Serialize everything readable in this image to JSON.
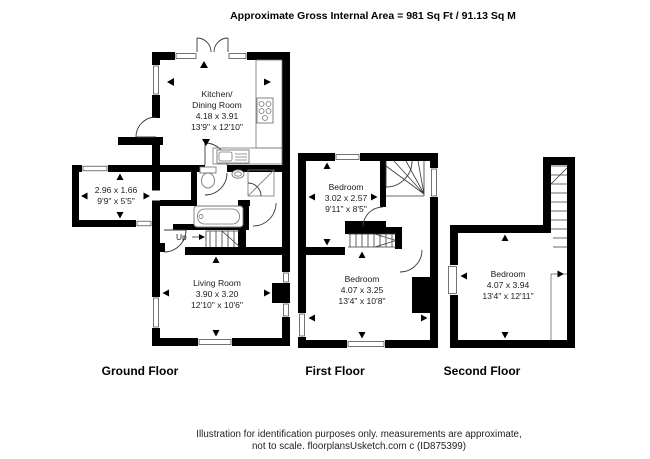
{
  "header": {
    "title": "Approximate Gross Internal Area = 981 Sq Ft / 91.13 Sq M"
  },
  "floors": {
    "ground": {
      "label": "Ground Floor",
      "kitchen": {
        "name1": "Kitchen/",
        "name2": "Dining Room",
        "metric": "4.18 x 3.91",
        "imperial": "13'9\" x 12'10\""
      },
      "annex": {
        "metric": "2.96 x 1.66",
        "imperial": "9'9\" x 5'5\""
      },
      "living": {
        "name": "Living Room",
        "metric": "3.90 x 3.20",
        "imperial": "12'10\" x 10'6\""
      },
      "stairs_label": "Up"
    },
    "first": {
      "label": "First Floor",
      "bedroom_small": {
        "name": "Bedroom",
        "metric": "3.02 x 2.57",
        "imperial": "9'11\" x 8'5\""
      },
      "bedroom_large": {
        "name": "Bedroom",
        "metric": "4.07 x 3.25",
        "imperial": "13'4\" x 10'8\""
      }
    },
    "second": {
      "label": "Second Floor",
      "bedroom": {
        "name": "Bedroom",
        "metric": "4.07 x 3.94",
        "imperial": "13'4\" x 12'11\""
      }
    }
  },
  "footer": {
    "line1": "Illustration for identification purposes only. measurements are approximate,",
    "line2": "not to scale. floorplansUsketch.com c (ID875399)"
  },
  "colors": {
    "wall": "#000000",
    "background": "#ffffff",
    "fixture_line": "#777777",
    "text": "#1b1b1b"
  }
}
